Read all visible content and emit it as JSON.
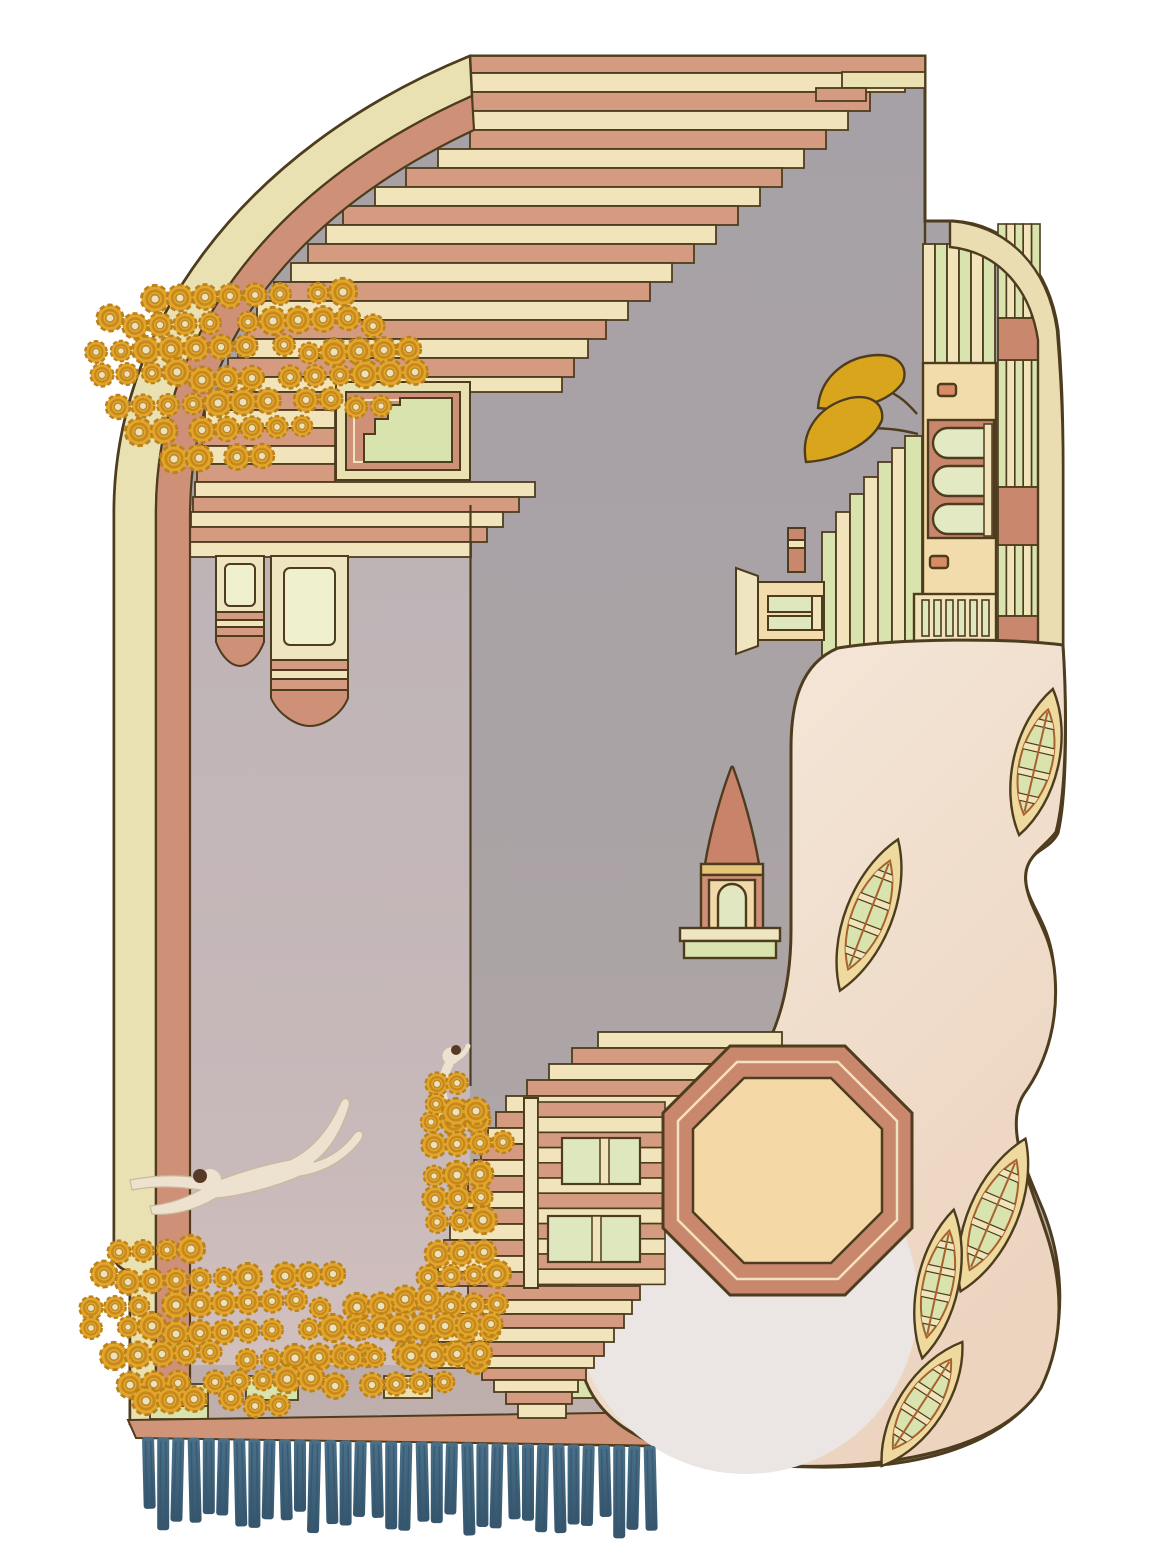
{
  "artwork": {
    "description": "Art-deco landscape rug: arched top-left corner with stepped terracotta and cream stripes cascading over a grey field, gold crochet flower clusters, two hanging pendant lanterns, a diving swimmer and a climbing monkey on a rope, a sideways pastel skyline with a mustard tree on the right edge, a blush pond with five canoes, a spire over an octagonal plaza with staircases, brick bands and a teal fringe along the bottom."
  },
  "palette": {
    "outline": "#4e3c1e",
    "pink": "#d59b80",
    "pink_deep": "#cf9078",
    "cream": "#f1e4ba",
    "cream_border": "#eae1b3",
    "cream_pale": "#eef0ce",
    "green": "#d8e3ae",
    "green_pale": "#dfe7bf",
    "gray": "#a8a2a5",
    "gray_low": "#c2b1ae",
    "panel_hi": "#bdb3b6",
    "panel_lo": "#d2c0bd",
    "peach": "#f4d8a6",
    "facade": "#f3dcab",
    "terracotta": "#c9886e",
    "pond_hi": "#f6eadd",
    "pond_lo": "#ecd4bf",
    "pond_circle": "#ebe5e3",
    "boat_hull": "#eeda9e",
    "gold": "#e3a62c",
    "gold_dark": "#bb811b",
    "gold_center": "#ece0bd",
    "mustard": "#d9a51d",
    "teal": "#4a7089",
    "teal_dark": "#35566d",
    "figure": "#ece2cf",
    "hair": "#573a26"
  },
  "motifs": {
    "flower_clusters": 4,
    "canoes": 5,
    "pendant_lanterns": 2,
    "figures": [
      "diving swimmer",
      "climbing monkey"
    ],
    "fringe_tassels": 34
  },
  "geometry": {
    "cascade_rows": [
      [
        56,
        17,
        470,
        925,
        "p"
      ],
      [
        73,
        19,
        470,
        905,
        "c"
      ],
      [
        92,
        19,
        470,
        870,
        "p"
      ],
      [
        111,
        19,
        470,
        848,
        "c"
      ],
      [
        130,
        19,
        470,
        826,
        "p"
      ],
      [
        149,
        19,
        438,
        804,
        "c"
      ],
      [
        168,
        19,
        406,
        782,
        "p"
      ],
      [
        187,
        19,
        375,
        760,
        "c"
      ],
      [
        206,
        19,
        343,
        738,
        "p"
      ],
      [
        225,
        19,
        326,
        716,
        "c"
      ],
      [
        244,
        19,
        308,
        694,
        "p"
      ],
      [
        263,
        19,
        291,
        672,
        "c"
      ],
      [
        282,
        19,
        274,
        650,
        "p"
      ],
      [
        301,
        19,
        257,
        628,
        "c"
      ],
      [
        320,
        19,
        247,
        606,
        "p"
      ],
      [
        339,
        19,
        238,
        588,
        "c"
      ],
      [
        358,
        19,
        228,
        574,
        "p"
      ],
      [
        377,
        15,
        218,
        562,
        "c"
      ],
      [
        392,
        18,
        207,
        335,
        "p"
      ],
      [
        410,
        18,
        205,
        335,
        "c"
      ],
      [
        428,
        18,
        202,
        335,
        "p"
      ],
      [
        446,
        18,
        200,
        335,
        "c"
      ],
      [
        464,
        18,
        197,
        335,
        "p"
      ],
      [
        482,
        15,
        195,
        535,
        "c"
      ],
      [
        497,
        15,
        193,
        519,
        "p"
      ],
      [
        512,
        15,
        191,
        503,
        "c"
      ],
      [
        527,
        15,
        190,
        487,
        "p"
      ],
      [
        542,
        15,
        190,
        471,
        "c"
      ]
    ],
    "fragment_rows": [
      [
        72,
        16,
        842,
        925,
        "c2"
      ],
      [
        88,
        13,
        816,
        866,
        "p"
      ]
    ],
    "green_steps": [
      [
        822,
        14,
        532,
        700,
        "g"
      ],
      [
        836,
        14,
        512,
        700,
        "c"
      ],
      [
        850,
        14,
        494,
        700,
        "g"
      ],
      [
        864,
        14,
        477,
        700,
        "c"
      ],
      [
        878,
        14,
        462,
        700,
        "g"
      ],
      [
        892,
        13,
        448,
        700,
        "c"
      ],
      [
        905,
        17,
        436,
        658,
        "g"
      ]
    ],
    "facade_stripes": {
      "x0": 923,
      "w": 12,
      "n": 6,
      "y1": 244,
      "y2": 366,
      "colors": [
        "c",
        "g",
        "c",
        "g",
        "c",
        "g"
      ]
    },
    "right_col_stripe_groups": [
      [
        998,
        1040,
        224,
        318
      ],
      [
        998,
        1040,
        360,
        487
      ],
      [
        998,
        1040,
        545,
        616
      ]
    ],
    "right_col_blocks": [
      [
        998,
        318,
        42,
        42
      ],
      [
        998,
        487,
        42,
        58
      ],
      [
        998,
        616,
        42,
        44
      ]
    ],
    "colonnade": {
      "x0": 922,
      "w": 7,
      "n": 6,
      "pitch": 12,
      "y": 600,
      "h": 36
    },
    "stair_rows": [
      [
        1032,
        16,
        598,
        782,
        "c"
      ],
      [
        1048,
        16,
        572,
        782,
        "p"
      ],
      [
        1064,
        16,
        549,
        782,
        "c"
      ],
      [
        1080,
        16,
        527,
        782,
        "p"
      ],
      [
        1096,
        16,
        506,
        770,
        "c"
      ],
      [
        1112,
        16,
        496,
        533,
        "p"
      ],
      [
        1128,
        16,
        488,
        533,
        "c"
      ],
      [
        1144,
        16,
        481,
        533,
        "p"
      ],
      [
        1160,
        16,
        474,
        533,
        "c"
      ],
      [
        1176,
        16,
        468,
        533,
        "p"
      ],
      [
        1192,
        16,
        462,
        533,
        "c"
      ],
      [
        1208,
        16,
        456,
        533,
        "p"
      ],
      [
        1224,
        16,
        450,
        533,
        "c"
      ],
      [
        1240,
        16,
        444,
        533,
        "p"
      ],
      [
        1256,
        16,
        438,
        533,
        "c"
      ],
      [
        1272,
        14,
        432,
        533,
        "p"
      ],
      [
        1286,
        14,
        468,
        640,
        "p"
      ],
      [
        1300,
        14,
        456,
        632,
        "c"
      ],
      [
        1314,
        14,
        446,
        624,
        "p"
      ],
      [
        1328,
        14,
        438,
        614,
        "c"
      ],
      [
        1342,
        14,
        432,
        604,
        "p"
      ],
      [
        1356,
        12,
        430,
        594,
        "c"
      ],
      [
        1368,
        12,
        482,
        586,
        "p"
      ],
      [
        1380,
        12,
        494,
        578,
        "c"
      ],
      [
        1392,
        12,
        506,
        572,
        "p"
      ],
      [
        1404,
        14,
        518,
        566,
        "c"
      ]
    ],
    "house": {
      "x": 538,
      "w": 127,
      "y0": 1102,
      "rows": 12,
      "rowh": 15.2
    },
    "brick_rows": [
      [
        140,
        1360,
        525,
        14,
        "c"
      ],
      [
        134,
        1374,
        540,
        32,
        "t"
      ],
      [
        132,
        1406,
        544,
        14,
        "c"
      ]
    ],
    "brick_blocks": [
      [
        150,
        1384,
        58,
        22,
        "g"
      ],
      [
        246,
        1376,
        52,
        24,
        "g"
      ],
      [
        384,
        1376,
        48,
        22,
        "c2"
      ],
      [
        562,
        1376,
        46,
        22,
        "g"
      ],
      [
        150,
        1406,
        58,
        13,
        "g"
      ]
    ],
    "boats": [
      [
        1036,
        762,
        150,
        24,
        13
      ],
      [
        869,
        915,
        162,
        25,
        21
      ],
      [
        993,
        1215,
        166,
        26,
        23
      ],
      [
        938,
        1284,
        152,
        22,
        12
      ],
      [
        922,
        1404,
        148,
        24,
        33
      ]
    ],
    "flower_clusters": [
      {
        "name": "top-left",
        "step": 27,
        "rows": [
          [
            295,
            150,
            340
          ],
          [
            322,
            108,
            400
          ],
          [
            349,
            90,
            425
          ],
          [
            376,
            96,
            432
          ],
          [
            403,
            112,
            398
          ],
          [
            430,
            142,
            330
          ],
          [
            455,
            178,
            262
          ]
        ]
      },
      {
        "name": "bottom-left",
        "step": 26,
        "rows": [
          [
            1252,
            118,
            215
          ],
          [
            1278,
            98,
            340
          ],
          [
            1304,
            92,
            470
          ],
          [
            1330,
            96,
            500
          ],
          [
            1356,
            112,
            498
          ],
          [
            1382,
            132,
            452
          ],
          [
            1402,
            148,
            300
          ]
        ]
      },
      {
        "name": "right-strip",
        "step": 25,
        "rows": [
          [
            1120,
            432,
            502
          ],
          [
            1146,
            428,
            506
          ],
          [
            1172,
            436,
            508
          ],
          [
            1198,
            430,
            500
          ],
          [
            1224,
            438,
            506
          ],
          [
            1250,
            432,
            500
          ],
          [
            1276,
            428,
            506
          ],
          [
            1302,
            400,
            508
          ],
          [
            1328,
            368,
            508
          ],
          [
            1354,
            356,
            500
          ]
        ]
      },
      {
        "name": "monkey",
        "step": 22,
        "rows": [
          [
            1086,
            440,
            480
          ],
          [
            1108,
            430,
            482
          ]
        ]
      }
    ],
    "fringe": {
      "x0": 142,
      "count": 34,
      "pitch": 15.2,
      "width": 12,
      "base_y": 1437,
      "slope": 0.27
    }
  }
}
